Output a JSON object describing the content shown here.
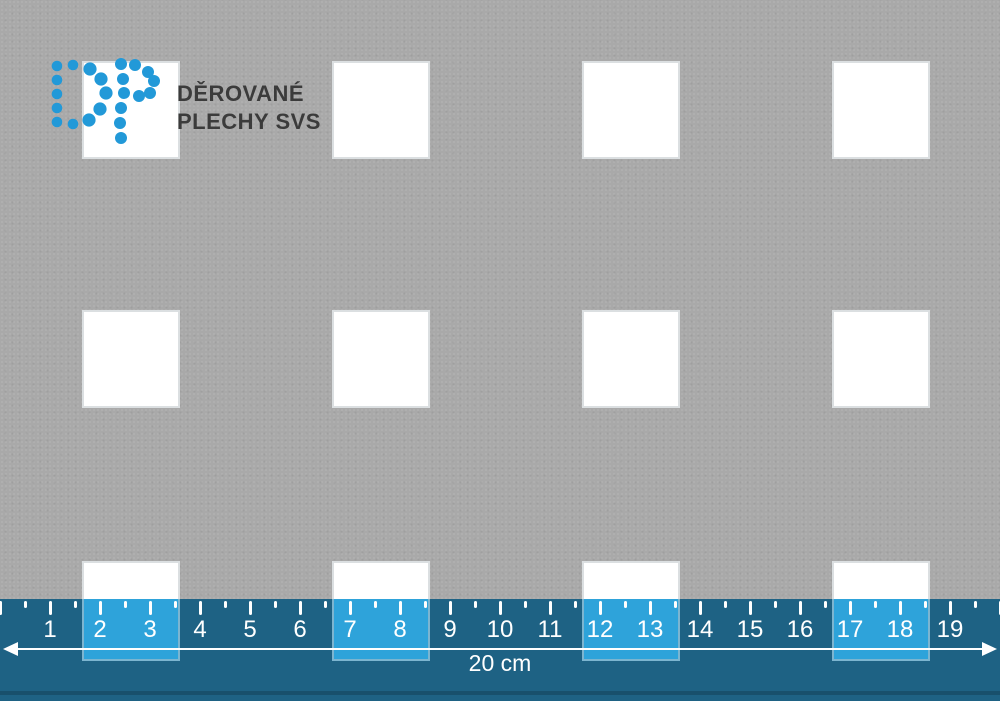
{
  "page": {
    "description": "Perforated sheet preview with square holes and a measuring ruler",
    "canvas": {
      "width": 1000,
      "height": 701
    }
  },
  "brand": {
    "logo_letters": "DP",
    "name_line1": "DĚROVANÉ",
    "name_line2": "PLECHY SVS",
    "dot_color": "#2299d8",
    "text_color": "#3b3b3b"
  },
  "sheet": {
    "color": "#a9a9a9",
    "hole_color": "#ffffff",
    "hole_shape": "square",
    "hole_size": 98,
    "hole_pitch": 250,
    "columns_x": [
      82,
      332,
      582,
      832
    ],
    "rows_y": [
      61,
      310,
      561
    ]
  },
  "ruler": {
    "top": 599,
    "height": 102,
    "px_per_cm": 50,
    "bg_color": "#1e6284",
    "hole_overlay_color": "#2ea3da",
    "mark_color": "#ffffff",
    "numbers": [
      "1",
      "2",
      "3",
      "4",
      "5",
      "6",
      "7",
      "8",
      "9",
      "10",
      "11",
      "12",
      "13",
      "14",
      "15",
      "16",
      "17",
      "18",
      "19"
    ],
    "length_label": "20 cm"
  }
}
